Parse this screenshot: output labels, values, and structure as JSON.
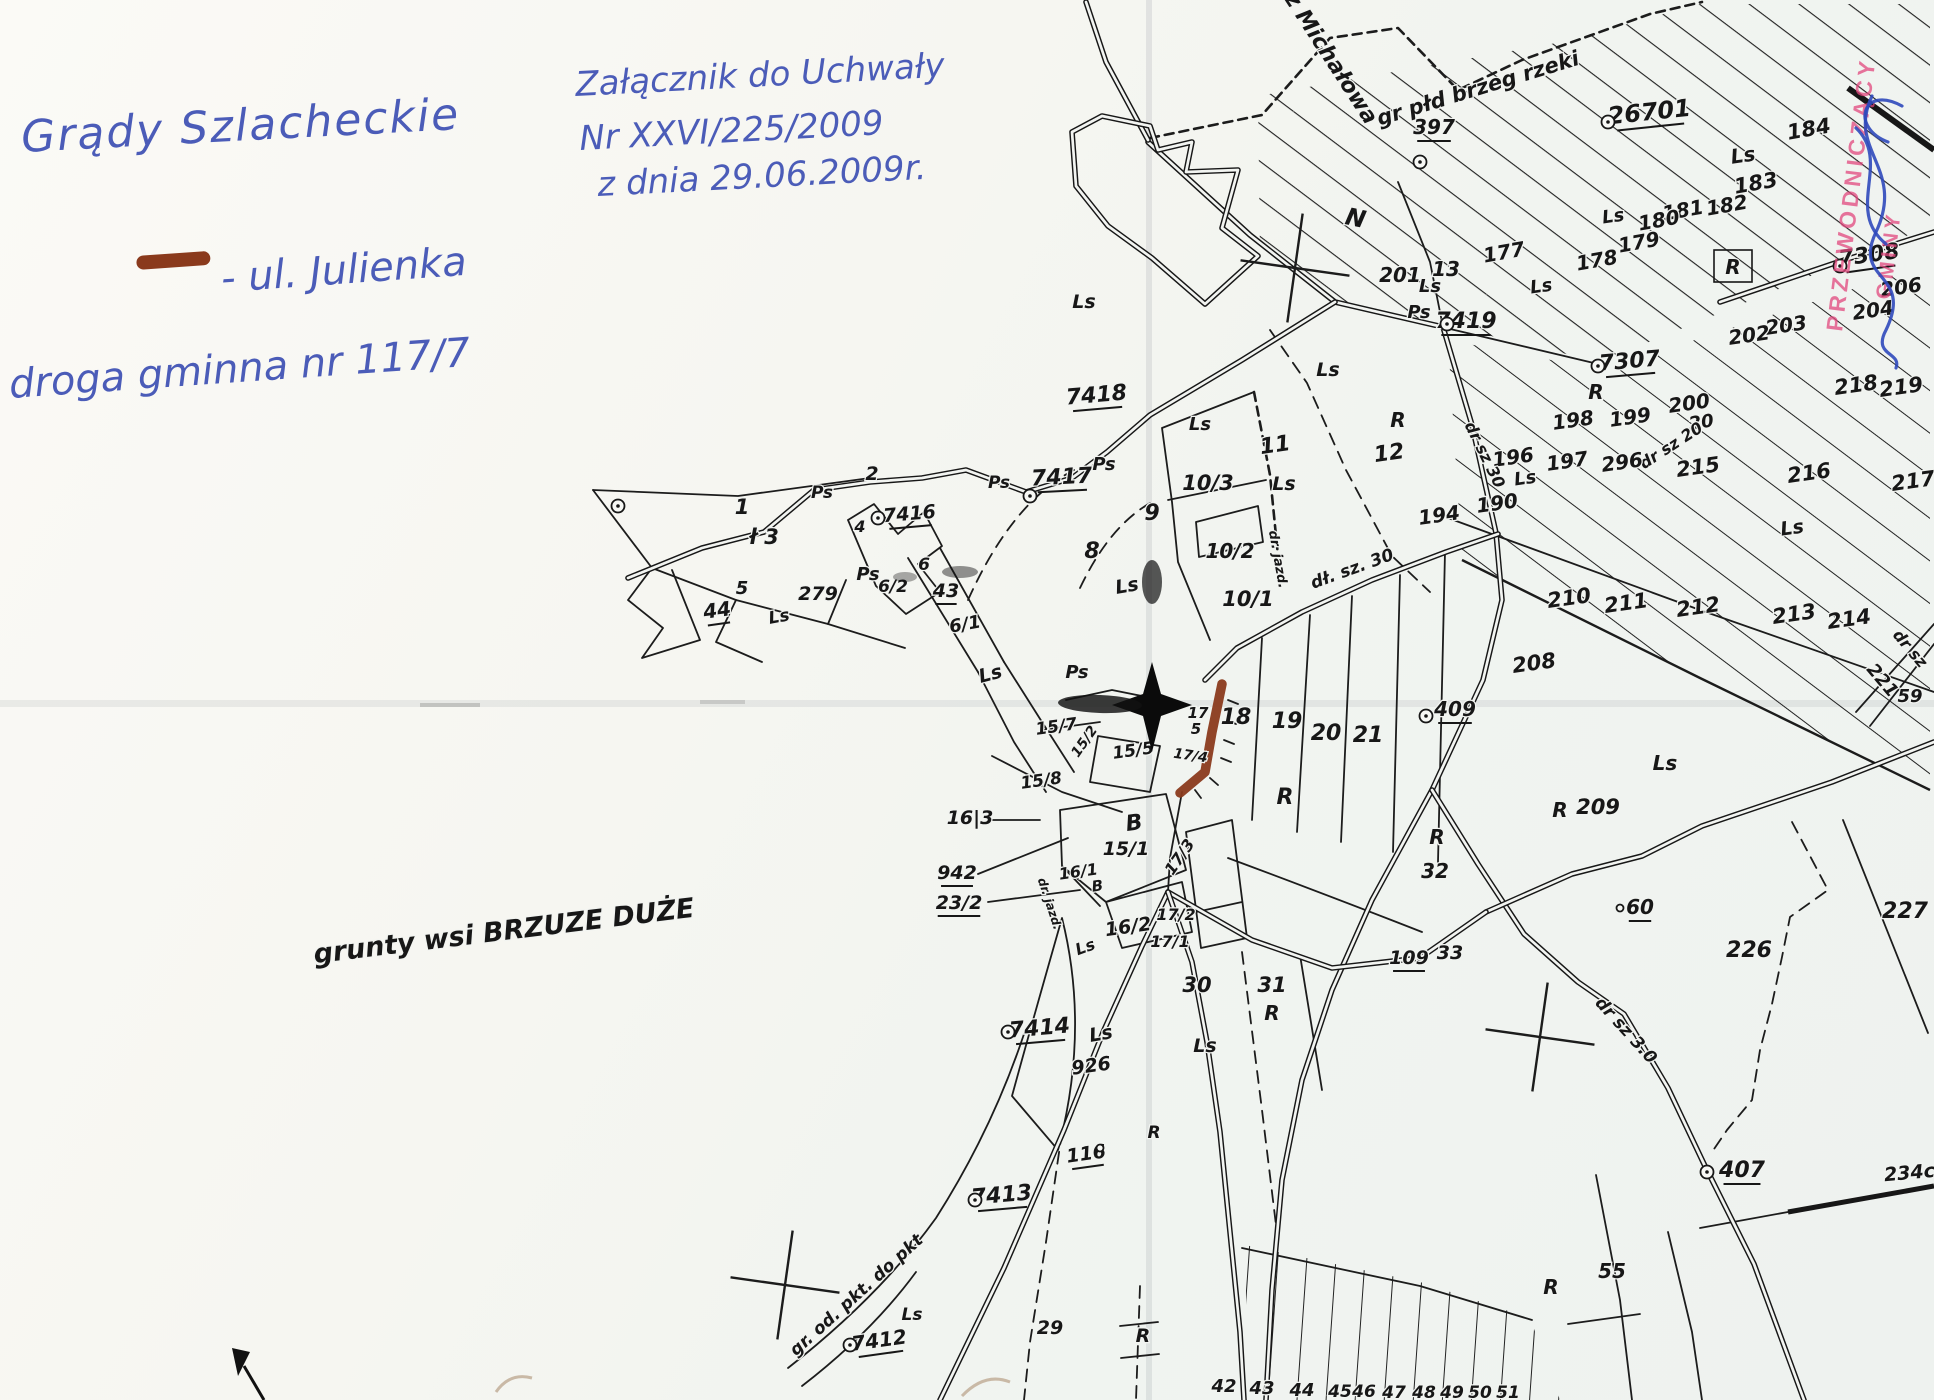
{
  "colors": {
    "ink": "#4b5cb8",
    "highlight": "#8a3a1c",
    "stamp": "#e2487e",
    "sig": "#2f49bb"
  },
  "annotations": {
    "place_title": "Grądy Szlacheckie",
    "legend_label": "- ul. Julienka",
    "legend_sub": "droga gminna nr 117/7",
    "attachment1": "Załącznik do Uchwały",
    "attachment2": "Nr XXVI/225/2009",
    "attachment3": "z dnia 29.06.2009r."
  },
  "stamp": {
    "line1": "PRZEWODNICZĄCY",
    "line2": "GMINY"
  },
  "map": {
    "labels": [
      {
        "t": "1",
        "x": 742,
        "y": 514,
        "s": 21
      },
      {
        "t": "2",
        "x": 872,
        "y": 480,
        "s": 19
      },
      {
        "t": "ł 3",
        "x": 764,
        "y": 544,
        "s": 21
      },
      {
        "t": "4",
        "x": 860,
        "y": 532,
        "s": 16
      },
      {
        "t": "5",
        "x": 742,
        "y": 594,
        "s": 18
      },
      {
        "t": "279",
        "x": 818,
        "y": 600,
        "s": 19
      },
      {
        "t": "44",
        "x": 718,
        "y": 617,
        "s": 20,
        "r": -8,
        "u": 1
      },
      {
        "t": "Ls",
        "x": 780,
        "y": 622,
        "s": 17,
        "r": -10
      },
      {
        "t": "Ps",
        "x": 822,
        "y": 498,
        "s": 17
      },
      {
        "t": "7416",
        "x": 910,
        "y": 520,
        "s": 19,
        "r": -5,
        "u": 1,
        "n": "survey-point-label"
      },
      {
        "t": "6",
        "x": 924,
        "y": 570,
        "s": 17
      },
      {
        "t": "6/2",
        "x": 893,
        "y": 592,
        "s": 17
      },
      {
        "t": "43",
        "x": 946,
        "y": 597,
        "s": 19,
        "u": 1
      },
      {
        "t": "6/1",
        "x": 966,
        "y": 630,
        "s": 18,
        "r": -10
      },
      {
        "t": "Ps",
        "x": 868,
        "y": 580,
        "s": 18
      },
      {
        "t": "Ls",
        "x": 992,
        "y": 680,
        "s": 19,
        "r": -15
      },
      {
        "t": "Ls",
        "x": 1128,
        "y": 592,
        "s": 19,
        "r": -10
      },
      {
        "t": "Ps",
        "x": 999,
        "y": 488,
        "s": 17
      },
      {
        "t": "Ps",
        "x": 1104,
        "y": 470,
        "s": 18
      },
      {
        "t": "7417",
        "x": 1062,
        "y": 484,
        "s": 22,
        "r": -3,
        "u": 1,
        "n": "survey-point-label"
      },
      {
        "t": "7418",
        "x": 1097,
        "y": 402,
        "s": 22,
        "r": -5,
        "u": 1,
        "n": "survey-point-label"
      },
      {
        "t": "8",
        "x": 1092,
        "y": 558,
        "s": 22
      },
      {
        "t": "9",
        "x": 1152,
        "y": 520,
        "s": 22
      },
      {
        "t": "Ls",
        "x": 1084,
        "y": 308,
        "s": 19
      },
      {
        "t": "10/3",
        "x": 1208,
        "y": 490,
        "s": 21
      },
      {
        "t": "10/2",
        "x": 1230,
        "y": 558,
        "s": 20
      },
      {
        "t": "10/1",
        "x": 1248,
        "y": 606,
        "s": 21
      },
      {
        "t": "Ls",
        "x": 1200,
        "y": 430,
        "s": 18
      },
      {
        "t": "dł. sz. 30",
        "x": 1354,
        "y": 574,
        "s": 17,
        "r": -20,
        "n": "road-label"
      },
      {
        "t": "dr. jazd.",
        "x": 1274,
        "y": 560,
        "s": 13,
        "r": 80,
        "n": "road-label"
      },
      {
        "t": "11",
        "x": 1276,
        "y": 452,
        "s": 22,
        "r": -8
      },
      {
        "t": "12",
        "x": 1390,
        "y": 460,
        "s": 22,
        "r": -8
      },
      {
        "t": "R",
        "x": 1398,
        "y": 427,
        "s": 20
      },
      {
        "t": "Ls",
        "x": 1328,
        "y": 376,
        "s": 19
      },
      {
        "t": "Ls",
        "x": 1284,
        "y": 490,
        "s": 19
      },
      {
        "t": "Ps",
        "x": 1419,
        "y": 318,
        "s": 18
      },
      {
        "t": "7419",
        "x": 1466,
        "y": 328,
        "s": 22,
        "u": 1,
        "n": "survey-point-label"
      },
      {
        "t": "13",
        "x": 1446,
        "y": 276,
        "s": 20
      },
      {
        "t": "N",
        "x": 1354,
        "y": 226,
        "s": 24,
        "r": 12
      },
      {
        "t": "z Michałowa",
        "x": 1325,
        "y": 62,
        "s": 22,
        "r": 57,
        "n": "direction-label"
      },
      {
        "t": "gr płd brzeg rzeki",
        "x": 1480,
        "y": 95,
        "s": 21,
        "r": -17,
        "n": "boundary-label"
      },
      {
        "t": "397",
        "x": 1434,
        "y": 134,
        "s": 20,
        "u": 1,
        "n": "survey-point-label"
      },
      {
        "t": "26701",
        "x": 1650,
        "y": 120,
        "s": 24,
        "r": -6,
        "u": 1,
        "n": "survey-point-label"
      },
      {
        "t": "Ls",
        "x": 1744,
        "y": 162,
        "s": 20,
        "r": -8
      },
      {
        "t": "184",
        "x": 1810,
        "y": 136,
        "s": 21,
        "r": -10
      },
      {
        "t": "183",
        "x": 1757,
        "y": 190,
        "s": 21,
        "r": -10
      },
      {
        "t": "182",
        "x": 1728,
        "y": 212,
        "s": 20,
        "r": -10
      },
      {
        "t": "181",
        "x": 1684,
        "y": 217,
        "s": 20,
        "r": -10
      },
      {
        "t": "180",
        "x": 1660,
        "y": 227,
        "s": 20,
        "r": -10
      },
      {
        "t": "179",
        "x": 1640,
        "y": 249,
        "s": 20,
        "r": -10
      },
      {
        "t": "Ls",
        "x": 1614,
        "y": 222,
        "s": 18,
        "r": -8
      },
      {
        "t": "178",
        "x": 1598,
        "y": 267,
        "s": 20,
        "r": -10
      },
      {
        "t": "177",
        "x": 1505,
        "y": 259,
        "s": 20,
        "r": -10
      },
      {
        "t": "Ls",
        "x": 1542,
        "y": 292,
        "s": 18,
        "r": -8
      },
      {
        "t": "R",
        "x": 1733,
        "y": 274,
        "s": 20
      },
      {
        "t": "7308",
        "x": 1870,
        "y": 262,
        "s": 22,
        "r": -8,
        "u": 1,
        "n": "survey-point-label"
      },
      {
        "t": "206",
        "x": 1902,
        "y": 294,
        "s": 20,
        "r": -8
      },
      {
        "t": "204",
        "x": 1874,
        "y": 317,
        "s": 20,
        "r": -8
      },
      {
        "t": "203",
        "x": 1787,
        "y": 332,
        "s": 20,
        "r": -8
      },
      {
        "t": "202",
        "x": 1750,
        "y": 342,
        "s": 20,
        "r": -8
      },
      {
        "t": "201",
        "x": 1400,
        "y": 282,
        "s": 20
      },
      {
        "t": "Ls",
        "x": 1430,
        "y": 292,
        "s": 18
      },
      {
        "t": "7307",
        "x": 1630,
        "y": 368,
        "s": 22,
        "r": -5,
        "u": 1,
        "n": "survey-point-label"
      },
      {
        "t": "R",
        "x": 1596,
        "y": 399,
        "s": 20
      },
      {
        "t": "198",
        "x": 1574,
        "y": 427,
        "s": 20,
        "r": -8
      },
      {
        "t": "199",
        "x": 1631,
        "y": 424,
        "s": 20,
        "r": -8
      },
      {
        "t": "200",
        "x": 1690,
        "y": 410,
        "s": 20,
        "r": -8
      },
      {
        "t": "20",
        "x": 1702,
        "y": 428,
        "s": 18,
        "r": -8
      },
      {
        "t": "dr sz 20",
        "x": 1674,
        "y": 450,
        "s": 16,
        "r": -33,
        "n": "road-label"
      },
      {
        "t": "218",
        "x": 1857,
        "y": 392,
        "s": 21,
        "r": -8
      },
      {
        "t": "219",
        "x": 1902,
        "y": 394,
        "s": 21,
        "r": -8
      },
      {
        "t": "196",
        "x": 1514,
        "y": 464,
        "s": 20,
        "r": -8
      },
      {
        "t": "197",
        "x": 1568,
        "y": 468,
        "s": 20,
        "r": -8
      },
      {
        "t": "296",
        "x": 1623,
        "y": 469,
        "s": 20,
        "r": -8
      },
      {
        "t": "215",
        "x": 1699,
        "y": 474,
        "s": 21,
        "r": -8
      },
      {
        "t": "216",
        "x": 1810,
        "y": 480,
        "s": 21,
        "r": -8
      },
      {
        "t": "217",
        "x": 1914,
        "y": 488,
        "s": 21,
        "r": -8
      },
      {
        "t": "Ls",
        "x": 1793,
        "y": 534,
        "s": 19,
        "r": -8
      },
      {
        "t": "dr sz 30",
        "x": 1480,
        "y": 457,
        "s": 16,
        "r": 64,
        "n": "road-label"
      },
      {
        "t": "194",
        "x": 1440,
        "y": 522,
        "s": 20,
        "r": -8
      },
      {
        "t": "190",
        "x": 1498,
        "y": 510,
        "s": 20,
        "r": -8
      },
      {
        "t": "Ls",
        "x": 1526,
        "y": 484,
        "s": 18,
        "r": -8
      },
      {
        "t": "210",
        "x": 1570,
        "y": 605,
        "s": 21,
        "r": -8
      },
      {
        "t": "211",
        "x": 1627,
        "y": 610,
        "s": 21,
        "r": -8
      },
      {
        "t": "212",
        "x": 1699,
        "y": 614,
        "s": 21,
        "r": -8
      },
      {
        "t": "213",
        "x": 1795,
        "y": 621,
        "s": 21,
        "r": -8
      },
      {
        "t": "214",
        "x": 1850,
        "y": 626,
        "s": 21,
        "r": -8
      },
      {
        "t": "221",
        "x": 1878,
        "y": 684,
        "s": 18,
        "r": 50,
        "n": "road-label"
      },
      {
        "t": "dr sz",
        "x": 1906,
        "y": 652,
        "s": 16,
        "r": 50,
        "n": "road-label"
      },
      {
        "t": "59",
        "x": 1910,
        "y": 702,
        "s": 18
      },
      {
        "t": "208",
        "x": 1535,
        "y": 670,
        "s": 21,
        "r": -8
      },
      {
        "t": "409",
        "x": 1455,
        "y": 716,
        "s": 20,
        "u": 1,
        "n": "survey-point-label"
      },
      {
        "t": "R",
        "x": 1437,
        "y": 844,
        "s": 20
      },
      {
        "t": "32",
        "x": 1435,
        "y": 878,
        "s": 20
      },
      {
        "t": "R",
        "x": 1560,
        "y": 817,
        "s": 20
      },
      {
        "t": "209",
        "x": 1598,
        "y": 814,
        "s": 21
      },
      {
        "t": "Ls",
        "x": 1665,
        "y": 770,
        "s": 20
      },
      {
        "t": "109",
        "x": 1409,
        "y": 964,
        "s": 19,
        "u": 1
      },
      {
        "t": "33",
        "x": 1450,
        "y": 959,
        "s": 19
      },
      {
        "t": "60",
        "x": 1640,
        "y": 914,
        "s": 20,
        "u": 1
      },
      {
        "t": "226",
        "x": 1749,
        "y": 957,
        "s": 22
      },
      {
        "t": "227",
        "x": 1905,
        "y": 918,
        "s": 22
      },
      {
        "t": "407",
        "x": 1742,
        "y": 1177,
        "s": 22,
        "u": 1,
        "n": "survey-point-label"
      },
      {
        "t": "234c",
        "x": 1910,
        "y": 1179,
        "s": 19,
        "r": -5
      },
      {
        "t": "dr sz 3.0",
        "x": 1622,
        "y": 1034,
        "s": 17,
        "r": 48,
        "n": "road-label"
      },
      {
        "t": "55",
        "x": 1612,
        "y": 1278,
        "s": 20
      },
      {
        "t": "R",
        "x": 1551,
        "y": 1294,
        "s": 20
      },
      {
        "t": "18",
        "x": 1236,
        "y": 724,
        "s": 22
      },
      {
        "t": "19",
        "x": 1287,
        "y": 728,
        "s": 22
      },
      {
        "t": "20",
        "x": 1326,
        "y": 740,
        "s": 22
      },
      {
        "t": "21",
        "x": 1368,
        "y": 742,
        "s": 22
      },
      {
        "t": "R",
        "x": 1285,
        "y": 804,
        "s": 22
      },
      {
        "t": "17",
        "x": 1198,
        "y": 718,
        "s": 15
      },
      {
        "t": "5",
        "x": 1196,
        "y": 734,
        "s": 15
      },
      {
        "t": "17/4",
        "x": 1190,
        "y": 760,
        "s": 14,
        "r": 8
      },
      {
        "t": "Ps",
        "x": 1077,
        "y": 678,
        "s": 18
      },
      {
        "t": "15/7",
        "x": 1057,
        "y": 732,
        "s": 17,
        "r": -8
      },
      {
        "t": "15/2",
        "x": 1088,
        "y": 744,
        "s": 14,
        "r": -55
      },
      {
        "t": "15/5",
        "x": 1134,
        "y": 756,
        "s": 17,
        "r": -8
      },
      {
        "t": "15/8",
        "x": 1042,
        "y": 786,
        "s": 17,
        "r": -8
      },
      {
        "t": "16|3",
        "x": 970,
        "y": 824,
        "s": 19
      },
      {
        "t": "942",
        "x": 957,
        "y": 879,
        "s": 19,
        "u": 1
      },
      {
        "t": "23/2",
        "x": 959,
        "y": 909,
        "s": 19,
        "u": 1
      },
      {
        "t": "B",
        "x": 1135,
        "y": 830,
        "s": 22,
        "r": -8
      },
      {
        "t": "15/1",
        "x": 1126,
        "y": 855,
        "s": 19
      },
      {
        "t": "16/1",
        "x": 1079,
        "y": 877,
        "s": 16,
        "r": -8
      },
      {
        "t": "B",
        "x": 1098,
        "y": 891,
        "s": 15,
        "r": -8
      },
      {
        "t": "16/2",
        "x": 1129,
        "y": 933,
        "s": 19,
        "r": -8
      },
      {
        "t": "17/3",
        "x": 1184,
        "y": 860,
        "s": 16,
        "r": -55
      },
      {
        "t": "17/2",
        "x": 1176,
        "y": 920,
        "s": 16
      },
      {
        "t": "17/1",
        "x": 1170,
        "y": 947,
        "s": 16
      },
      {
        "t": "dr. jazd.",
        "x": 1046,
        "y": 905,
        "s": 12,
        "r": 72,
        "n": "road-label"
      },
      {
        "t": "Ls",
        "x": 1087,
        "y": 952,
        "s": 16,
        "r": -20
      },
      {
        "t": "30",
        "x": 1197,
        "y": 992,
        "s": 21
      },
      {
        "t": "31",
        "x": 1272,
        "y": 992,
        "s": 21
      },
      {
        "t": "R",
        "x": 1272,
        "y": 1020,
        "s": 20
      },
      {
        "t": "Ls",
        "x": 1205,
        "y": 1052,
        "s": 19
      },
      {
        "t": "Ls",
        "x": 1102,
        "y": 1040,
        "s": 19,
        "r": -10
      },
      {
        "t": "7414",
        "x": 1040,
        "y": 1035,
        "s": 22,
        "r": -5,
        "u": 1,
        "n": "survey-point-label"
      },
      {
        "t": "926",
        "x": 1092,
        "y": 1072,
        "s": 19,
        "r": -8
      },
      {
        "t": "116",
        "x": 1087,
        "y": 1160,
        "s": 19,
        "r": -8,
        "u": 1
      },
      {
        "t": "7413",
        "x": 1002,
        "y": 1202,
        "s": 22,
        "r": -5,
        "u": 1,
        "n": "survey-point-label"
      },
      {
        "t": "7412",
        "x": 880,
        "y": 1347,
        "s": 20,
        "r": -8,
        "u": 1,
        "n": "survey-point-label"
      },
      {
        "t": "gr. od. pkt. do pkt",
        "x": 860,
        "y": 1299,
        "s": 17,
        "r": -42,
        "n": "boundary-label"
      },
      {
        "t": "Ls",
        "x": 912,
        "y": 1320,
        "s": 17
      },
      {
        "t": "29",
        "x": 1050,
        "y": 1334,
        "s": 19
      },
      {
        "t": "R",
        "x": 1143,
        "y": 1342,
        "s": 19
      },
      {
        "t": "R",
        "x": 1154,
        "y": 1138,
        "s": 17
      },
      {
        "t": "42",
        "x": 1224,
        "y": 1392,
        "s": 18
      },
      {
        "t": "43",
        "x": 1262,
        "y": 1394,
        "s": 18
      },
      {
        "t": "44",
        "x": 1302,
        "y": 1396,
        "s": 18
      },
      {
        "t": "45",
        "x": 1340,
        "y": 1397,
        "s": 17
      },
      {
        "t": "46",
        "x": 1364,
        "y": 1397,
        "s": 17
      },
      {
        "t": "47",
        "x": 1394,
        "y": 1398,
        "s": 17
      },
      {
        "t": "48",
        "x": 1424,
        "y": 1398,
        "s": 17
      },
      {
        "t": "49",
        "x": 1452,
        "y": 1398,
        "s": 17
      },
      {
        "t": "50",
        "x": 1480,
        "y": 1398,
        "s": 17
      },
      {
        "t": "51",
        "x": 1508,
        "y": 1398,
        "s": 17
      },
      {
        "t": "grunty wsi BRZUZE DUŻE",
        "x": 505,
        "y": 940,
        "s": 27,
        "r": -7,
        "n": "village-note"
      }
    ],
    "points": [
      [
        1608,
        122
      ],
      [
        1420,
        162
      ],
      [
        1447,
        324
      ],
      [
        1840,
        266
      ],
      [
        1598,
        366
      ],
      [
        1030,
        496
      ],
      [
        878,
        518
      ],
      [
        1008,
        1032
      ],
      [
        975,
        1200
      ],
      [
        850,
        1345
      ],
      [
        1707,
        1172
      ],
      [
        1426,
        716
      ],
      [
        618,
        506
      ]
    ],
    "rings": [
      [
        1100,
        1148
      ],
      [
        1620,
        908
      ]
    ],
    "crosses": [
      [
        1295,
        268
      ],
      [
        1540,
        1037
      ],
      [
        785,
        1285
      ]
    ]
  }
}
